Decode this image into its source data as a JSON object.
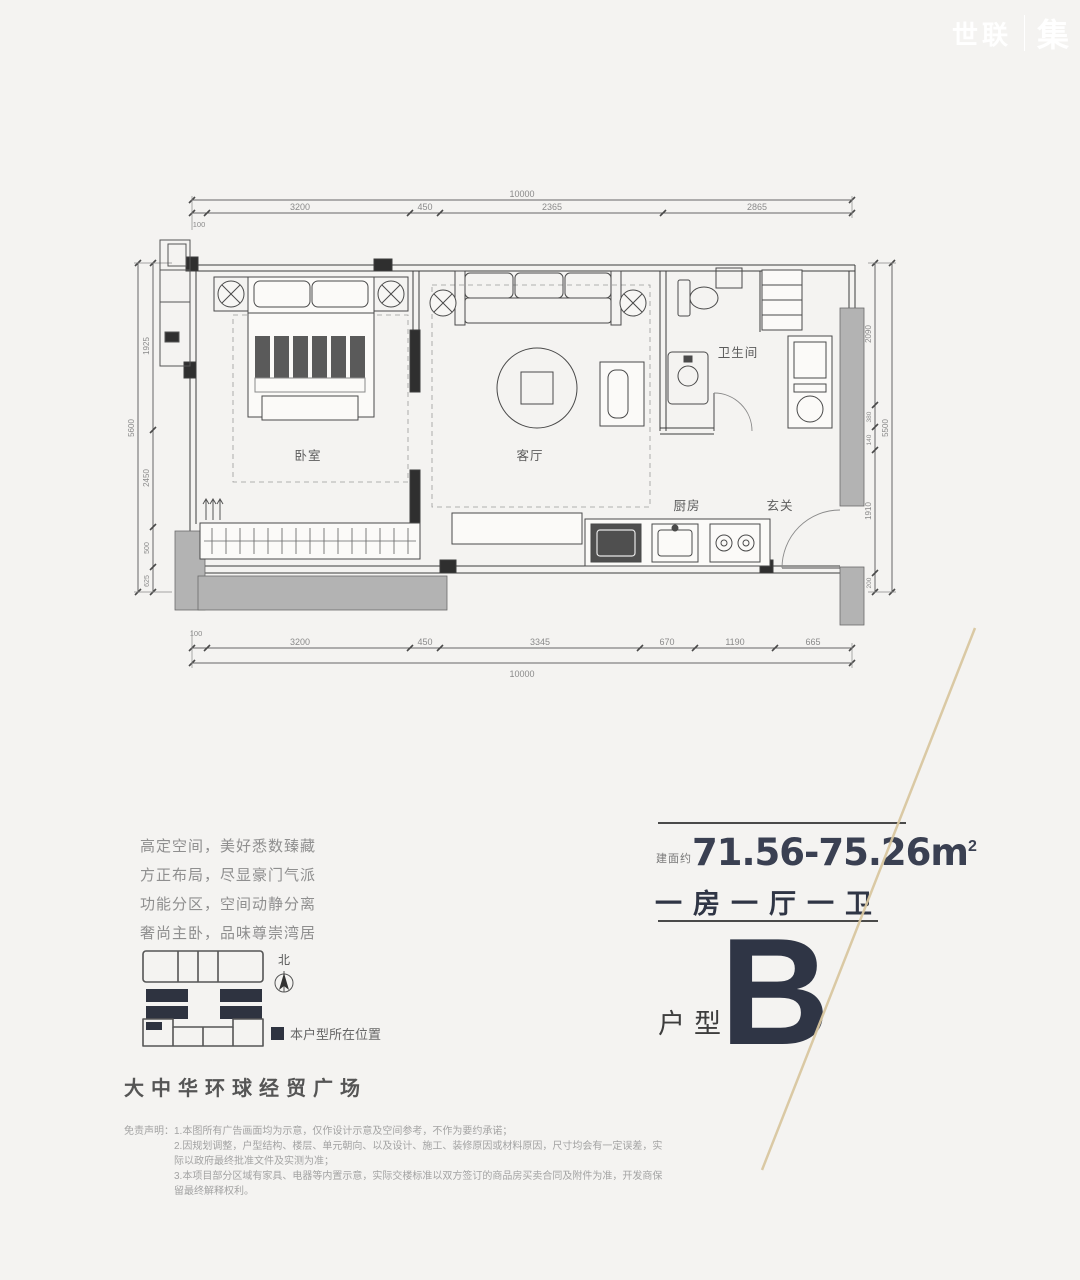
{
  "watermark": {
    "brand": "世联",
    "mark": "集"
  },
  "floor_plan": {
    "rooms": {
      "bedroom": "卧室",
      "living": "客厅",
      "bathroom": "卫生间",
      "kitchen": "厨房",
      "foyer": "玄关"
    },
    "dim_top": {
      "overall": "10000",
      "offset": "100",
      "segments": [
        "3200",
        "450",
        "2365",
        "2865"
      ]
    },
    "dim_bottom": {
      "overall": "10000",
      "offset": "100",
      "segments": [
        "3200",
        "450",
        "3345",
        "670",
        "1190",
        "665"
      ]
    },
    "dim_left": {
      "overall": "5600",
      "segments": [
        "1925",
        "2450",
        "500",
        "625"
      ]
    },
    "dim_right": {
      "overall": "5500",
      "segments": [
        "2090",
        "380",
        "140",
        "1910",
        "200"
      ]
    }
  },
  "marketing": {
    "lines": [
      "高定空间，美好悉数臻藏",
      "方正布局，尽显豪门气派",
      "功能分区，空间动静分离",
      "奢尚主卧，品味尊崇湾居"
    ]
  },
  "key_plan": {
    "north": "北",
    "legend": "本户型所在位置"
  },
  "project": {
    "name": "大中华环球经贸广场"
  },
  "unit": {
    "area_prefix": "建面约",
    "area_value": "71.56-75.26m",
    "area_sup": "2",
    "layout": "一房一厅一卫",
    "type_label": "户型",
    "type_letter": "B"
  },
  "disclaimer": {
    "label": "免责声明：",
    "lines": [
      "1.本图所有广告画面均为示意，仅作设计示意及空间参考，不作为要约承诺；",
      "2.因规划调整，户型结构、楼层、单元朝向、以及设计、施工、装修原因或材料原因，尺寸均会有一定误差，实际以政府最终批准文件及实测为准；",
      "3.本项目部分区域有家具、电器等内置示意，实际交楼标准以双方签订的商品房买卖合同及附件为准，开发商保留最终解释权利。"
    ]
  },
  "colors": {
    "accent_dark": "#2f3545",
    "dim_line": "#555555",
    "wall_gray": "#b3b3b3",
    "tan_line": "#d9c7a0"
  }
}
